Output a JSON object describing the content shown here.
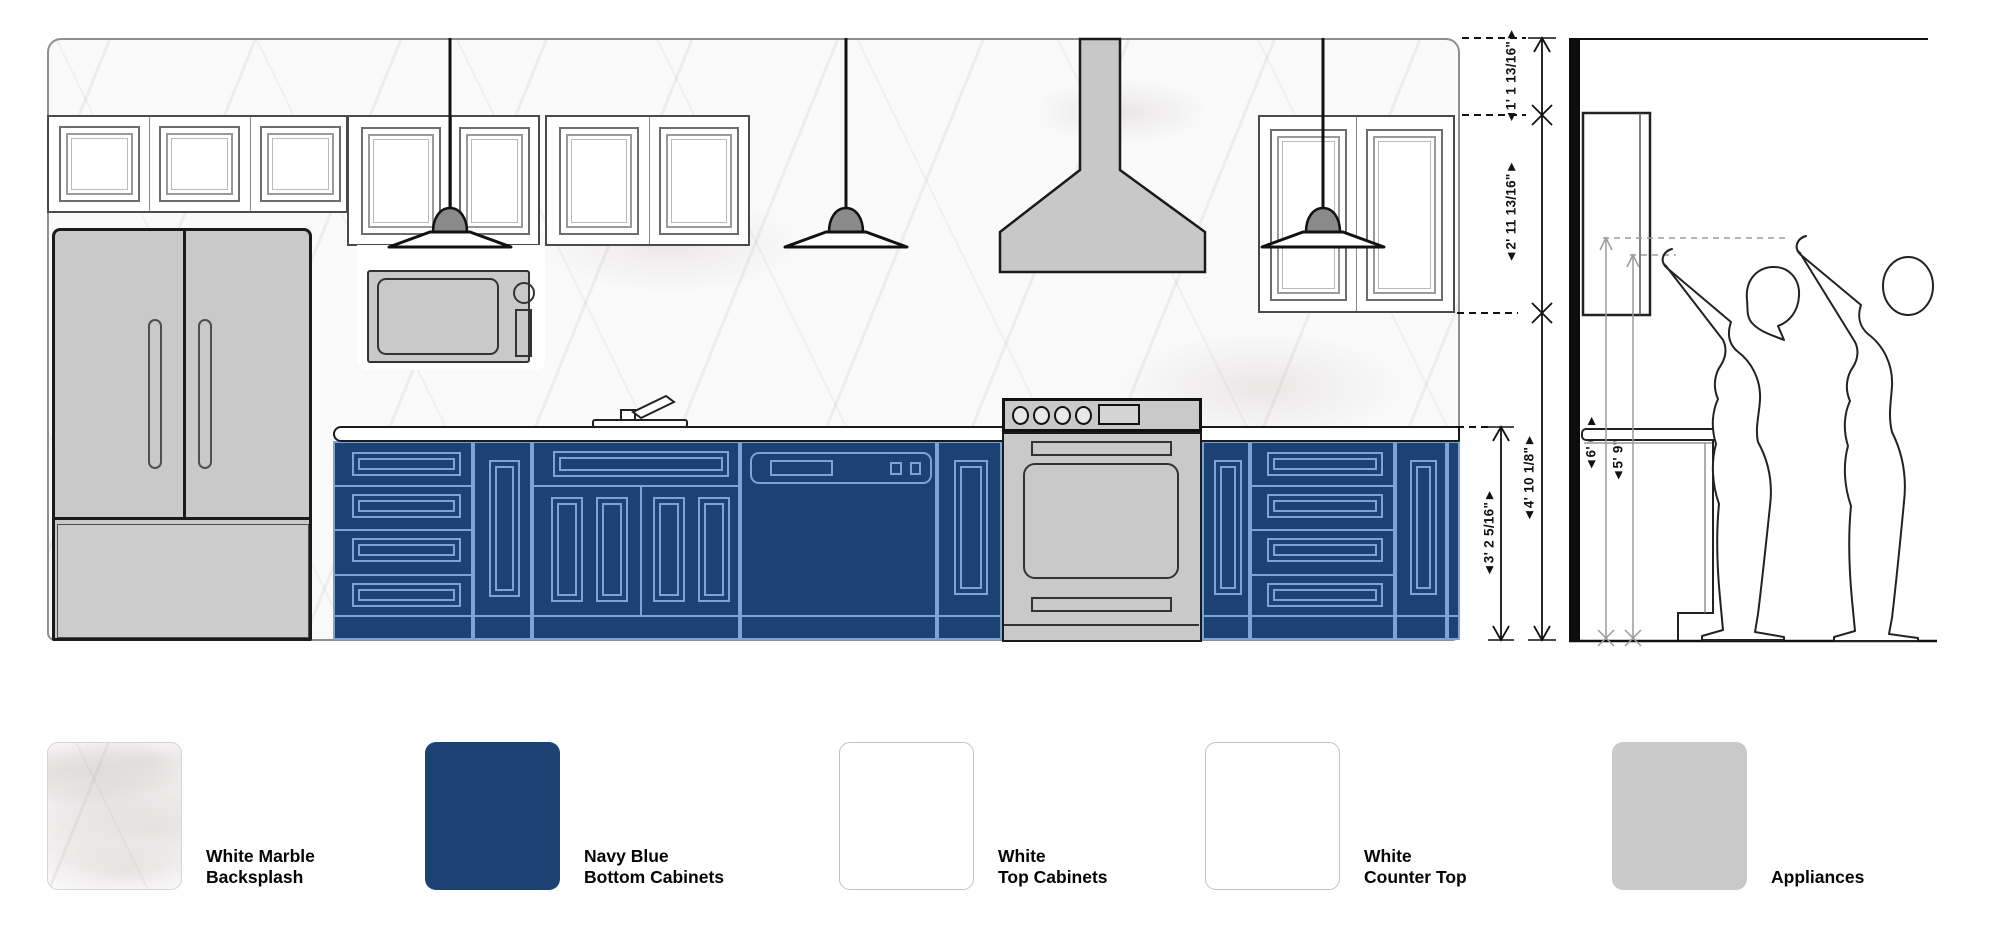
{
  "dimensions": {
    "elevation": [
      {
        "id": "ceiling-to-cabinet-top",
        "label": "◄1' 1 13/16\"►"
      },
      {
        "id": "upper-cabinet-height",
        "label": "◄2' 11 13/16\"►"
      },
      {
        "id": "floor-to-upper-cabinet",
        "label": "◄4' 10 1/8\"►"
      },
      {
        "id": "counter-height",
        "label": "◄3' 2 5/16\"►"
      }
    ],
    "side": [
      {
        "id": "tall-reach",
        "label": "◄6' 0\"►"
      },
      {
        "id": "short-reach",
        "label": "◄5' 9\"►"
      }
    ]
  },
  "legend": {
    "items": [
      {
        "id": "backsplash",
        "lines": [
          "White Marble",
          "Backsplash"
        ],
        "swatch": "marble"
      },
      {
        "id": "bottom-cabinets",
        "lines": [
          "Navy Blue",
          "Bottom Cabinets"
        ],
        "swatch": "#1b4273"
      },
      {
        "id": "top-cabinets",
        "lines": [
          "White",
          "Top Cabinets"
        ],
        "swatch": "#ffffff"
      },
      {
        "id": "counter-top",
        "lines": [
          "White",
          "Counter Top"
        ],
        "swatch": "#ffffff"
      },
      {
        "id": "appliances",
        "lines": [
          "Appliances"
        ],
        "swatch": "#c9c9c9"
      }
    ]
  },
  "colors": {
    "navy_cabinet": "#1b4273",
    "cabinet_outline": "#7ba3d4",
    "appliance_gray": "#c9c9c9",
    "outline": "#1a1a1a"
  }
}
